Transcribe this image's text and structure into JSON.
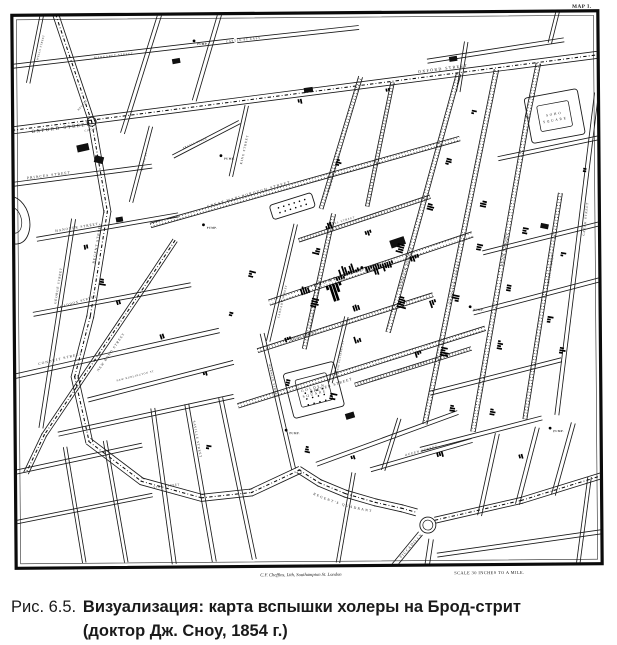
{
  "figure": {
    "label": "Рис. 6.5.",
    "caption_line1": "Визуализация: карта вспышки холеры на Брод-стрит",
    "caption_line2": "(доктор Дж. Сноу, 1854 г.)"
  },
  "map": {
    "corner_label": "MAP 1.",
    "attribution": "C.F. Cheffins, Lith, Southampton St. London",
    "scale_note": "SCALE 30 INCHES TO A MILE.",
    "quadrant_label": "REGENT'S QUADRANT",
    "pump_label": "PUMP.",
    "ink": "#1a1a1a",
    "streets": [
      [
        6,
        1,
        0,
        [
          58,
          13,
          93,
          120
        ]
      ],
      [
        7,
        1,
        0,
        [
          93,
          120,
          108,
          210,
          90,
          315,
          74,
          375,
          88,
          440,
          140,
          480,
          200,
          497,
          250,
          492,
          298,
          470
        ]
      ],
      [
        7,
        1,
        0,
        [
          298,
          470,
          318,
          483,
          344,
          494,
          374,
          503,
          400,
          509,
          414,
          513
        ]
      ],
      [
        6,
        1,
        0,
        [
          434,
          521,
          520,
          502,
          600,
          478
        ]
      ],
      [
        7,
        1,
        0,
        [
          14,
          128,
          600,
          57
        ]
      ],
      [
        5,
        1,
        0,
        [
          175,
          240,
          148,
          280,
          43,
          433,
          25,
          470
        ]
      ],
      [
        4,
        0,
        0,
        [
          14,
          64,
          235,
          40
        ]
      ],
      [
        4,
        0,
        0,
        [
          240,
          40,
          360,
          28
        ]
      ],
      [
        4,
        0,
        0,
        [
          14,
          182,
          152,
          165
        ]
      ],
      [
        4,
        0,
        0,
        [
          38,
          237,
          178,
          214
        ]
      ],
      [
        4,
        0,
        0,
        [
          34,
          312,
          190,
          284
        ]
      ],
      [
        4.5,
        0,
        0,
        [
          14,
          374,
          218,
          330
        ]
      ],
      [
        4,
        0,
        0,
        [
          88,
          398,
          232,
          362
        ]
      ],
      [
        4,
        0,
        0,
        [
          58,
          432,
          232,
          396
        ]
      ],
      [
        4,
        0,
        0,
        [
          162,
          13,
          124,
          131
        ]
      ],
      [
        3.5,
        0,
        0,
        [
          44,
          13,
          30,
          80
        ]
      ],
      [
        4,
        0,
        0,
        [
          222,
          13,
          196,
          99
        ]
      ],
      [
        4,
        0,
        0,
        [
          74,
          218,
          40,
          425
        ]
      ],
      [
        4,
        0,
        0,
        [
          152,
          408,
          172,
          562
        ]
      ],
      [
        4,
        0,
        0,
        [
          186,
          404,
          212,
          560
        ]
      ],
      [
        4,
        0,
        0,
        [
          220,
          398,
          252,
          558
        ]
      ],
      [
        4,
        0,
        0,
        [
          14,
          470,
          140,
          444
        ]
      ],
      [
        3.5,
        0,
        0,
        [
          64,
          446,
          82,
          560
        ]
      ],
      [
        3.5,
        0,
        0,
        [
          104,
          440,
          124,
          560
        ]
      ],
      [
        3.5,
        0,
        0,
        [
          14,
          520,
          150,
          494
        ]
      ],
      [
        4.5,
        0,
        1,
        [
          152,
          224,
          460,
          140
        ]
      ],
      [
        5.5,
        0,
        1,
        [
          270,
          302,
          472,
          236
        ]
      ],
      [
        4,
        0,
        1,
        [
          258,
          350,
          432,
          296
        ]
      ],
      [
        4.5,
        0,
        1,
        [
          238,
          405,
          484,
          330
        ]
      ],
      [
        3.5,
        0,
        1,
        [
          355,
          385,
          470,
          350
        ]
      ],
      [
        3.5,
        0,
        1,
        [
          300,
          240,
          430,
          198
        ]
      ],
      [
        4,
        0,
        1,
        [
          322,
          208,
          362,
          78
        ]
      ],
      [
        3.5,
        0,
        1,
        [
          368,
          206,
          394,
          84
        ]
      ],
      [
        4.5,
        0,
        1,
        [
          388,
          332,
          460,
          76
        ]
      ],
      [
        4.5,
        0,
        1,
        [
          424,
          424,
          498,
          72
        ]
      ],
      [
        4.5,
        0,
        1,
        [
          472,
          432,
          529,
          118,
          540,
          66
        ]
      ],
      [
        4,
        0,
        1,
        [
          524,
          420,
          561,
          196
        ]
      ],
      [
        4,
        0,
        0,
        [
          556,
          416,
          598,
          96
        ]
      ],
      [
        4,
        0,
        1,
        [
          304,
          348,
          334,
          215
        ]
      ],
      [
        3.5,
        0,
        0,
        [
          268,
          340,
          296,
          225
        ]
      ],
      [
        3.5,
        0,
        0,
        [
          330,
          382,
          346,
          318
        ]
      ],
      [
        4,
        0,
        0,
        [
          262,
          334,
          292,
          468
        ]
      ],
      [
        3.5,
        0,
        0,
        [
          248,
          106,
          232,
          175
        ]
      ],
      [
        3.5,
        0,
        0,
        [
          152,
          126,
          132,
          200
        ]
      ],
      [
        3.5,
        0,
        0,
        [
          175,
          155,
          240,
          122
        ]
      ],
      [
        3.5,
        0,
        0,
        [
          352,
          474,
          336,
          562
        ]
      ],
      [
        5,
        0,
        0,
        [
          418,
          535,
          392,
          566
        ]
      ],
      [
        4.5,
        0,
        0,
        [
          429,
          541,
          425,
          566
        ]
      ],
      [
        4,
        0,
        0,
        [
          496,
          436,
          478,
          516
        ]
      ],
      [
        4,
        0,
        0,
        [
          536,
          430,
          516,
          505
        ]
      ],
      [
        4,
        0,
        0,
        [
          572,
          426,
          552,
          496
        ]
      ],
      [
        3.5,
        0,
        0,
        [
          588,
          480,
          576,
          566
        ]
      ],
      [
        4,
        0,
        0,
        [
          484,
          254,
          600,
          226
        ]
      ],
      [
        4,
        0,
        0,
        [
          474,
          314,
          600,
          282
        ]
      ],
      [
        4,
        0,
        0,
        [
          430,
          394,
          560,
          362
        ]
      ],
      [
        4,
        0,
        0,
        [
          420,
          450,
          540,
          420
        ]
      ],
      [
        4,
        0,
        0,
        [
          370,
          470,
          470,
          442
        ]
      ],
      [
        4,
        0,
        0,
        [
          436,
          556,
          600,
          534
        ]
      ],
      [
        4,
        0,
        0,
        [
          430,
          62,
          565,
          42
        ]
      ],
      [
        3.5,
        0,
        0,
        [
          468,
          44,
          460,
          92
        ]
      ],
      [
        3.5,
        0,
        0,
        [
          560,
          13,
          552,
          44
        ]
      ],
      [
        4,
        0,
        0,
        [
          500,
          160,
          600,
          140
        ]
      ],
      [
        4,
        0,
        0,
        [
          316,
          464,
          456,
          414
        ]
      ],
      [
        3.5,
        0,
        0,
        [
          398,
          420,
          382,
          470
        ]
      ]
    ],
    "labels": [
      [
        "OXFORD STREET",
        33,
        131,
        -7,
        4.8,
        1.6
      ],
      [
        "OXFORD STREET",
        420,
        74,
        -7,
        4,
        1.4
      ],
      [
        "REGENT STREET",
        95,
        262,
        -80,
        3.6,
        1
      ],
      [
        "REGENT",
        80,
        109,
        -48,
        2.6,
        0.6
      ],
      [
        "CIRCUS",
        86,
        130,
        -12,
        2.6,
        0.6
      ],
      [
        "MARGARET STREET",
        96,
        57,
        -6,
        2.9,
        0.8
      ],
      [
        "WELLS STREET",
        40,
        58,
        -75,
        2.6,
        0.6
      ],
      [
        "PRINCES STREET",
        28,
        177,
        -7,
        3.6,
        1.1
      ],
      [
        "HANOVER STREET",
        56,
        230,
        -9,
        3.4,
        1
      ],
      [
        "MADDOX STREET",
        60,
        306,
        -16,
        3.2,
        0.9
      ],
      [
        "CONDUIT STREET",
        38,
        363,
        -13,
        3.6,
        1.1
      ],
      [
        "GEORGE STREET",
        56,
        302,
        -80,
        3.2,
        0.9
      ],
      [
        "NEW BOND STREET",
        98,
        370,
        -55,
        3.4,
        1
      ],
      [
        "NEW BURLINGTON ST",
        116,
        380,
        -14,
        2.6,
        0.7
      ],
      [
        "SAVILLE STREET",
        192,
        420,
        80,
        3.2,
        0.9
      ],
      [
        "VIGO STREET",
        152,
        487,
        -6,
        2.8,
        0.8
      ],
      [
        "ARGYLL ST",
        143,
        170,
        -74,
        2.6,
        0.6
      ],
      [
        "ARGYLL PLACE",
        184,
        148,
        -22,
        2.6,
        0.6
      ],
      [
        "KING STREET",
        243,
        164,
        -77,
        3.2,
        0.9
      ],
      [
        "GREAT MARLBOROUGH STREET",
        208,
        207,
        -16,
        3.7,
        1.3
      ],
      [
        "POLAND STREET",
        330,
        192,
        -73,
        3.3,
        0.9
      ],
      [
        "NOEL STREET",
        330,
        226,
        -17,
        2.8,
        0.8
      ],
      [
        "BERWICK STREET",
        401,
        290,
        -74,
        3.5,
        1
      ],
      [
        "WARDOUR STREET",
        451,
        306,
        -78,
        3.5,
        1
      ],
      [
        "DEAN STREET",
        503,
        268,
        -80,
        3.5,
        1
      ],
      [
        "FRITH STREET",
        549,
        288,
        -81,
        3.2,
        0.9
      ],
      [
        "GREEK STREET",
        585,
        238,
        -83,
        3.2,
        0.9
      ],
      [
        "BROAD STREET",
        314,
        287,
        -18,
        4.6,
        2
      ],
      [
        "MARSHALL STREET",
        311,
        328,
        -77,
        3,
        0.8
      ],
      [
        "CARNABY STREET",
        279,
        318,
        -76,
        2.8,
        0.7
      ],
      [
        "BEAK STREET",
        290,
        341,
        -17,
        3,
        0.8
      ],
      [
        "BREWER STREET",
        310,
        393,
        -17,
        3.7,
        1.1
      ],
      [
        "GREAT PULTENEY ST",
        337,
        375,
        -79,
        2.5,
        0.6
      ],
      [
        "PETER STREET",
        398,
        372,
        -16,
        3,
        0.8
      ],
      [
        "QUEEN STREET",
        404,
        457,
        -15,
        3.2,
        0.9
      ],
      [
        "PICCADILLY",
        399,
        559,
        -47,
        3.6,
        1.1
      ],
      [
        "CASTLE ST EAST",
        228,
        42,
        -6,
        3,
        0.8
      ],
      [
        "WARWICK STREET",
        268,
        364,
        78,
        2.8,
        0.7
      ]
    ],
    "squares": [
      {
        "cx": 556,
        "cy": 118,
        "ow": 54,
        "oh": 46,
        "iw": 32,
        "ih": 26,
        "rot": -10,
        "lines": [
          "SOHO",
          "SQUARE"
        ]
      },
      {
        "cx": 313,
        "cy": 390,
        "ow": 52,
        "oh": 46,
        "iw": 32,
        "ih": 28,
        "rot": -14,
        "lines": [
          "GOLDEN",
          "SQUARE"
        ],
        "dots": {
          "r": 3,
          "c": 4,
          "sx": 6,
          "sy": 6
        }
      },
      {
        "cx": 293,
        "cy": 206,
        "ow": 44,
        "oh": 15,
        "iw": 0,
        "ih": 0,
        "rot": -17,
        "dots": {
          "r": 2,
          "c": 6,
          "sx": 5.5,
          "sy": 5
        }
      },
      {
        "e": 1,
        "cx": 14,
        "cy": 218,
        "rx": 16,
        "ry": 24,
        "rx2": 8,
        "ry2": 13,
        "rot": -12
      }
    ],
    "circles": [
      {
        "cx": 93,
        "cy": 120,
        "r1": 4.5,
        "r2": 0
      },
      {
        "cx": 426,
        "cy": 526,
        "r1": 8,
        "r2": 5
      }
    ],
    "buildings": [
      [
        84,
        146,
        12,
        7,
        -12
      ],
      [
        100,
        158,
        7,
        9,
        -75
      ],
      [
        398,
        243,
        15,
        8,
        -18
      ],
      [
        310,
        90,
        9,
        5,
        -8
      ],
      [
        349,
        416,
        9,
        6,
        -16
      ],
      [
        178,
        60,
        8,
        5,
        -10
      ],
      [
        545,
        228,
        5,
        8,
        -78
      ],
      [
        455,
        60,
        8,
        5,
        -8
      ],
      [
        120,
        218,
        7,
        5,
        -9
      ]
    ],
    "pumps": [
      [
        362,
        268
      ],
      [
        222,
        155
      ],
      [
        204,
        224
      ],
      [
        196,
        40
      ],
      [
        470,
        308
      ],
      [
        285,
        430
      ],
      [
        549,
        430
      ]
    ],
    "deaths": [
      [
        333,
        284,
        -18,
        5,
        18,
        1,
        2.6
      ],
      [
        352,
        274,
        -18,
        7,
        8,
        -1
      ],
      [
        372,
        266,
        -18,
        6,
        9,
        1
      ],
      [
        341,
        280,
        -18,
        4,
        10,
        -1
      ],
      [
        386,
        263,
        -18,
        6,
        7,
        1
      ],
      [
        306,
        294,
        -18,
        4,
        6,
        -1
      ],
      [
        414,
        256,
        -18,
        4,
        5,
        1
      ],
      [
        398,
        302,
        -74,
        5,
        7,
        1
      ],
      [
        404,
        250,
        -74,
        4,
        5,
        -1
      ],
      [
        428,
        207,
        -74,
        3,
        5,
        1
      ],
      [
        447,
        162,
        -74,
        3,
        4,
        1
      ],
      [
        440,
        352,
        -78,
        4,
        6,
        1
      ],
      [
        459,
        300,
        -78,
        3,
        5,
        -1
      ],
      [
        477,
        248,
        -78,
        3,
        4,
        1
      ],
      [
        487,
        206,
        -78,
        3,
        4,
        -1
      ],
      [
        497,
        346,
        -79,
        4,
        5,
        1
      ],
      [
        511,
        290,
        -79,
        3,
        4,
        -1
      ],
      [
        523,
        232,
        -79,
        3,
        4,
        1
      ],
      [
        337,
        162,
        -73,
        3,
        4,
        1
      ],
      [
        320,
        252,
        -76,
        3,
        5,
        -1
      ],
      [
        311,
        302,
        -76,
        4,
        6,
        1
      ],
      [
        287,
        337,
        -17,
        3,
        4,
        1
      ],
      [
        358,
        343,
        -17,
        3,
        5,
        -1
      ],
      [
        417,
        352,
        -16,
        3,
        4,
        1
      ],
      [
        329,
        396,
        -78,
        3,
        5,
        1
      ],
      [
        289,
        383,
        -76,
        3,
        4,
        -1
      ],
      [
        449,
        409,
        -79,
        3,
        4,
        1
      ],
      [
        489,
        413,
        -79,
        3,
        4,
        1
      ],
      [
        547,
        321,
        -80,
        3,
        4,
        1
      ],
      [
        561,
        256,
        -80,
        2,
        3,
        1
      ],
      [
        249,
        273,
        -76,
        3,
        4,
        1
      ],
      [
        229,
        313,
        -76,
        2,
        3,
        1
      ],
      [
        161,
        333,
        -18,
        2,
        3,
        1
      ],
      [
        119,
        303,
        -18,
        2,
        3,
        -1
      ],
      [
        204,
        371,
        -14,
        2,
        3,
        1
      ],
      [
        301,
        99,
        -10,
        2,
        3,
        1
      ],
      [
        389,
        89,
        -11,
        2,
        3,
        1
      ],
      [
        473,
        113,
        -78,
        2,
        3,
        1
      ],
      [
        584,
        172,
        -82,
        2,
        3,
        1
      ],
      [
        351,
        456,
        -18,
        2,
        3,
        1
      ],
      [
        304,
        449,
        -76,
        3,
        4,
        1
      ],
      [
        438,
        453,
        -15,
        3,
        4,
        1
      ],
      [
        519,
        456,
        -15,
        2,
        3,
        1
      ],
      [
        205,
        446,
        -80,
        2,
        3,
        1
      ],
      [
        86,
        243,
        -9,
        2,
        3,
        1
      ],
      [
        559,
        352,
        -79,
        3,
        4,
        1
      ],
      [
        330,
        229,
        -18,
        3,
        4,
        -1
      ],
      [
        368,
        231,
        -18,
        3,
        4,
        1
      ],
      [
        432,
        301,
        -18,
        3,
        5,
        1
      ],
      [
        357,
        311,
        -18,
        3,
        4,
        -1
      ],
      [
        100,
        280,
        -80,
        3,
        4,
        1
      ]
    ]
  }
}
